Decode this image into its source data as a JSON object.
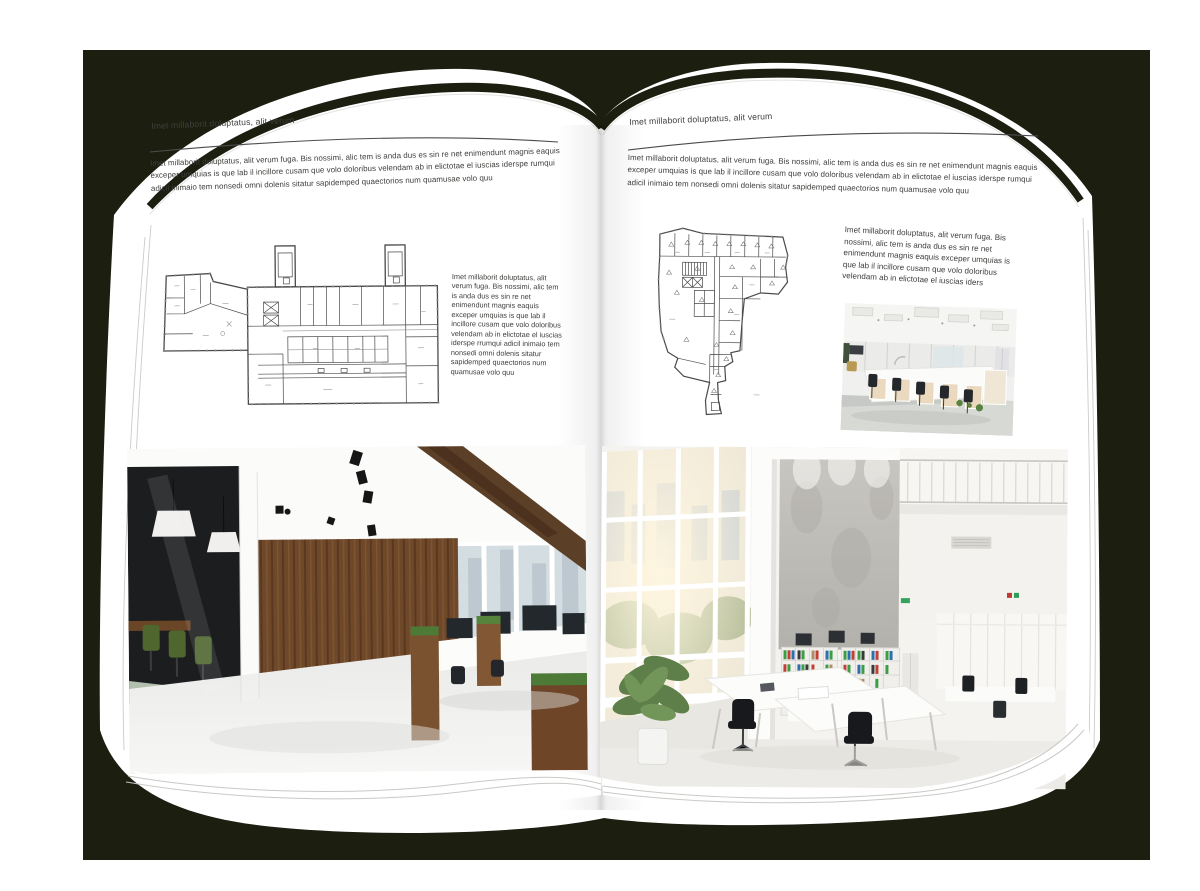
{
  "document": {
    "kind": "brochure-spread-mockup",
    "left_page": {
      "header": "Imet millaborit doluptatus, alit verum",
      "intro": "Imet millaborit doluptatus, alit verum fuga. Bis nossimi, alic tem is anda dus es sin re net enimendunt magnis eaquis exceper umquias is que lab il incillore cusam que volo doloribus velendam ab in elictotae el iuscias iderspe rumqui adicil inimaio tem nonsedi omni dolenis sitatur sapidemped quaectorios num quamusae volo quu",
      "aside": "Imet millaborit doluptatus, alit verum fuga. Bis nossimi, alic tem is anda dus es sin re net enimendunt magnis eaquis exceper umquias is que lab il incillore cusam que volo doloribus velendam ab in elictotae el iuscias iderspe rrumqui adicil inimaio tem nonsedi omni dolenis sitatur sapidemped quaectorios num quamusae volo quu",
      "floor_plan": "office-building-floor-plan-with-two-stair-towers",
      "photo": "loft-office-interior-glass-meeting-room-wood-wall"
    },
    "right_page": {
      "header": "Imet millaborit doluptatus, alit verum",
      "intro": "Imet millaborit doluptatus, alit verum fuga. Bis nossimi, alic tem is anda dus es sin re net enimendunt magnis eaquis exceper umquias is que lab il incillore cusam que volo doloribus velendam ab in elictotae el iuscias iderspe rumqui adicil inimaio tem nonsedi omni dolenis sitatur sapidemped quaectorios num quamusae volo quu",
      "aside": "Imet millaborit doluptatus, alit verum fuga. Bis nossimi, alic tem is anda dus es sin re net enimendunt magnis eaquis exceper umquias is que lab il incillore cusam que volo doloribus velendam ab in elictotae el iuscias iders",
      "floor_plan": "irregular-plan-office-tower-floor-plan",
      "photo_small": "open-office-workstation-cubicles",
      "photo_large": "double-height-white-office-atrium-with-binder-shelves"
    },
    "colors": {
      "backdrop": "#1c1e10",
      "page": "#ffffff",
      "ink": "#3f3e3c",
      "rule": "#4c4c4c",
      "plan_line": "#4a4a4a",
      "wood": "#6f482a",
      "chair_green": "#4f662e",
      "binder_green": "#3c9d44",
      "binder_red": "#c04035",
      "binder_blue": "#2e6fae"
    }
  }
}
